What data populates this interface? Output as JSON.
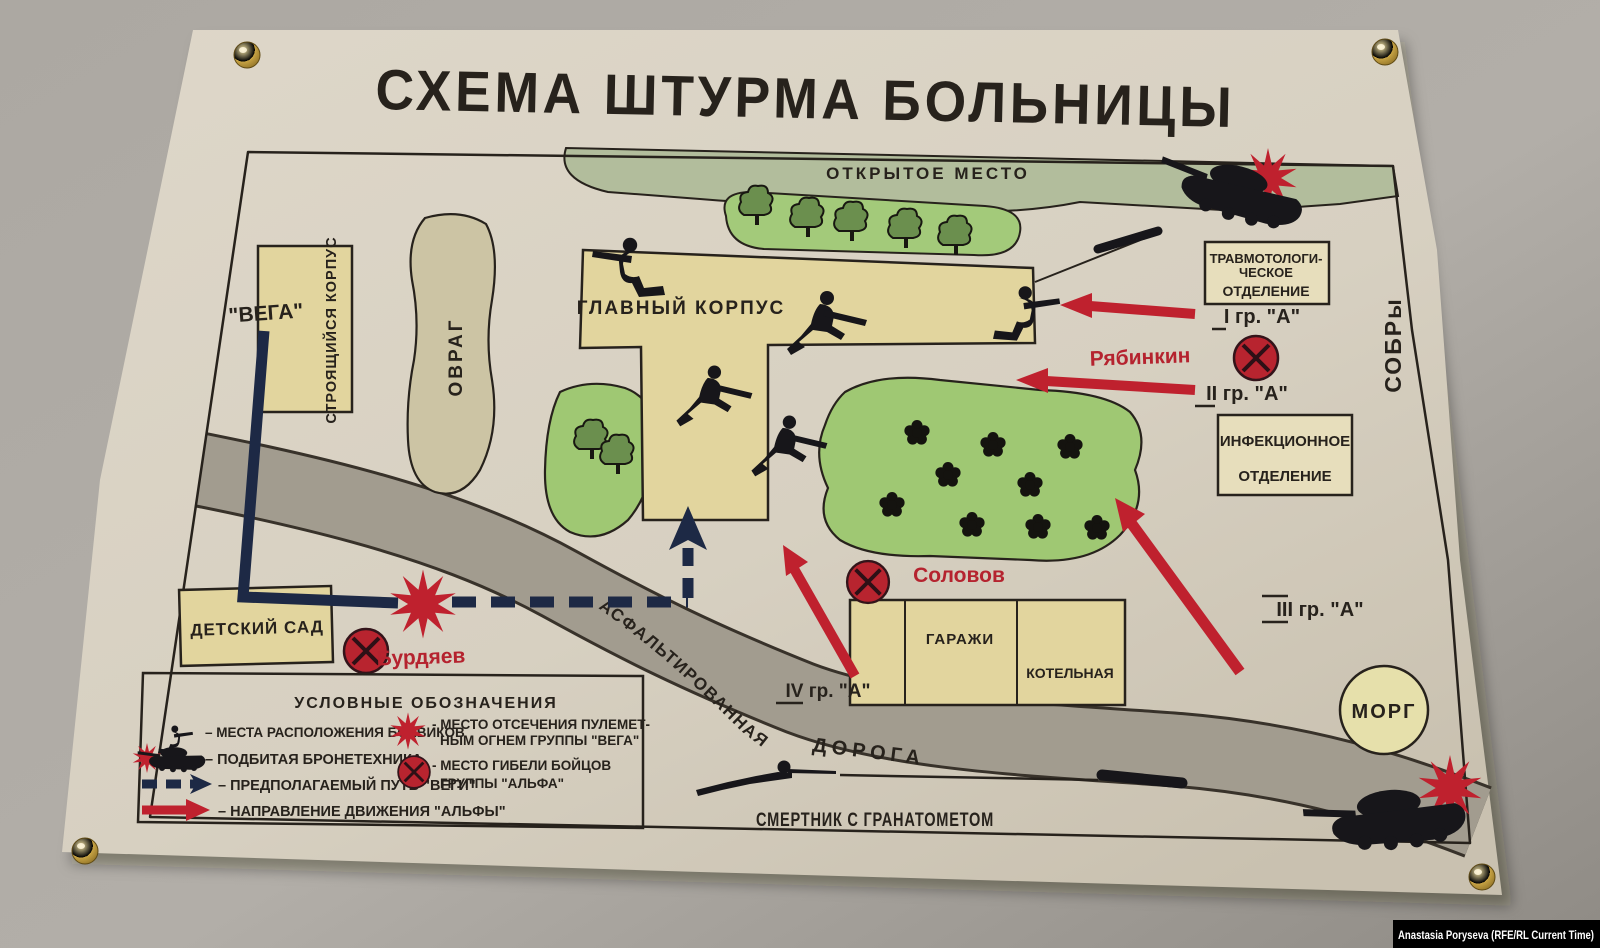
{
  "photo": {
    "credit": "Anastasia Poryseva (RFE/RL Current Time)",
    "wall_color": "#a7a39d"
  },
  "poster": {
    "title": "СХЕМА ШТУРМА БОЛЬНИЦЫ",
    "paper_color": "#d9d2c3",
    "ink_color": "#27221c",
    "accent_red": "#bf212e",
    "vega_navy": "#1d2945",
    "building_tan": "#e2d59e",
    "grass_green": "#a3ca7a",
    "open_field_green": "#b2bd9c",
    "road_gray": "#a29c8f",
    "areas": {
      "open_area": "ОТКРЫТОЕ МЕСТО",
      "ravine": "ОВРАГ",
      "construction": "СТРОЯЩИЙСЯ КОРПУС",
      "vega": "\"ВЕГА\"",
      "main_building": "ГЛАВНЫЙ КОРПУС",
      "kindergarten": "ДЕТСКИЙ САД",
      "garages": "ГАРАЖИ",
      "boiler": "КОТЕЛЬНАЯ",
      "morgue": "МОРГ",
      "sobr": "СОБРы",
      "road_word1": "АСФАЛЬТИРОВАННАЯ",
      "road_word2": "ДОРОГА",
      "suicide_bomber": "СМЕРТНИК С ГРАНАТОМЕТОМ"
    },
    "departments": {
      "trauma_1": "ТРАВМОТОЛОГИ-",
      "trauma_2": "ЧЕСКОЕ",
      "trauma_3": "ОТДЕЛЕНИЕ",
      "infection_1": "ИНФЕКЦИОННОЕ",
      "infection_2": "ОТДЕЛЕНИЕ"
    },
    "groups": {
      "g1": "I гр. \"А\"",
      "g2": "II гр. \"А\"",
      "g3": "III гр. \"А\"",
      "g4": "IV гр. \"А\""
    },
    "fallen": {
      "ryabinkin": "Рябинкин",
      "solovov": "Соловов",
      "burdyaev": "Бурдяев"
    },
    "legend": {
      "title": "УСЛОВНЫЕ ОБОЗНАЧЕНИЯ",
      "items": [
        {
          "icon": "militant-position",
          "label": "– МЕСТА РАСПОЛОЖЕНИЯ БОЕВИКОВ"
        },
        {
          "icon": "destroyed-armor",
          "label": "– ПОДБИТАЯ БРОНЕТЕХНИКА"
        },
        {
          "icon": "vega-dashed-path",
          "label": "– ПРЕДПОЛАГАЕМЫЙ ПУТЬ \"ВЕГИ\""
        },
        {
          "icon": "alpha-red-arrow",
          "label": "– НАПРАВЛЕНИЕ ДВИЖЕНИЯ \"АЛЬФЫ\""
        },
        {
          "icon": "mg-cutoff-star",
          "line1": "- МЕСТО ОТСЕЧЕНИЯ ПУЛЕМЕТ-",
          "line2": "НЫМ ОГНЕМ ГРУППЫ \"ВЕГА\""
        },
        {
          "icon": "alpha-death-site",
          "line1": "- МЕСТО ГИБЕЛИ БОЙЦОВ",
          "line2": "ГРУППЫ \"АЛЬФА\""
        }
      ]
    }
  }
}
